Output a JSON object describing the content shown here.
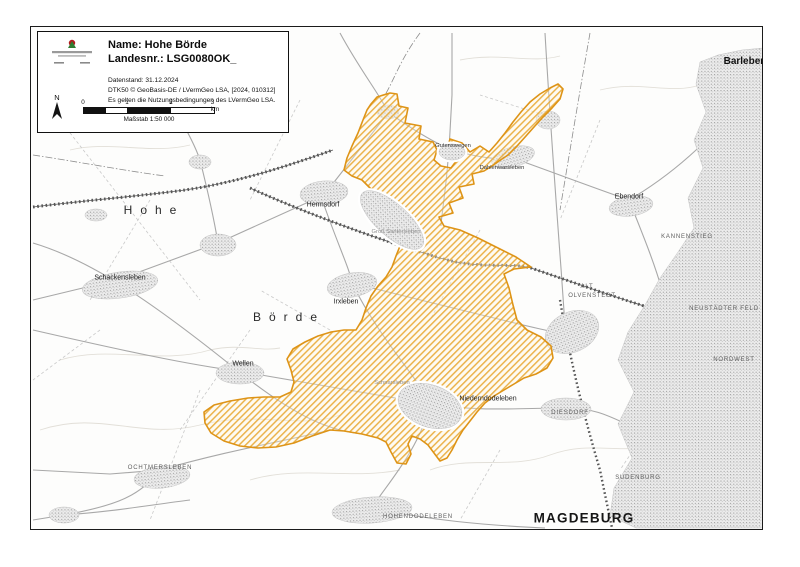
{
  "legend": {
    "name_label": "Name: Hohe Börde",
    "landesnr_label": "Landesnr.: LSG0080OK_",
    "datenstand": "Datenstand: 31.12.2024",
    "source": "DTK50 © GeoBasis-DE / LVermGeo LSA, [2024, 010312]",
    "terms": "Es gelten die Nutzungsbedingungen des LVermGeo LSA.",
    "north_label": "N",
    "scale_caption": "Maßstab 1:50 000",
    "scale_ticks": [
      "0",
      "1",
      "2",
      "3 km"
    ]
  },
  "colors": {
    "area_stroke": "#de9417",
    "area_hatch": "#e8a62e",
    "urban_fill": "#ececec",
    "road": "#a8a8a8",
    "rail": "#565656"
  },
  "map": {
    "area_name": "Hohe Börde",
    "labels": [
      {
        "text": "Hohe",
        "x": 154,
        "y": 210,
        "cls": "region"
      },
      {
        "text": "Börde",
        "x": 289,
        "y": 317,
        "cls": "region"
      },
      {
        "text": "Schackensleben",
        "x": 120,
        "y": 278,
        "cls": "place"
      },
      {
        "text": "Hermsdorf",
        "x": 323,
        "y": 205,
        "cls": "place"
      },
      {
        "text": "Irxleben",
        "x": 346,
        "y": 302,
        "cls": "place"
      },
      {
        "text": "Wellen",
        "x": 243,
        "y": 364,
        "cls": "place"
      },
      {
        "text": "Niederndodeleben",
        "x": 488,
        "y": 399,
        "cls": "place"
      },
      {
        "text": "Dahlenwarsleben",
        "x": 502,
        "y": 169,
        "cls": "place-sm"
      },
      {
        "text": "Gutenswegen",
        "x": 453,
        "y": 147,
        "cls": "place-sm"
      },
      {
        "text": "Groß Santersleben",
        "x": 396,
        "y": 233,
        "cls": "place-sm faint"
      },
      {
        "text": "Schnarsleben",
        "x": 392,
        "y": 384,
        "cls": "place-sm faint"
      },
      {
        "text": "Barleben",
        "x": 745,
        "y": 62,
        "cls": "place-lg"
      },
      {
        "text": "Ebendorf",
        "x": 629,
        "y": 197,
        "cls": "place"
      },
      {
        "text": "KANNENSTIEG",
        "x": 687,
        "y": 237,
        "cls": "caps"
      },
      {
        "text": "ALT",
        "x": 587,
        "y": 287,
        "cls": "caps"
      },
      {
        "text": "OLVENSTEDT",
        "x": 592,
        "y": 296,
        "cls": "caps"
      },
      {
        "text": "NEUSTÄDTER FELD",
        "x": 724,
        "y": 309,
        "cls": "caps"
      },
      {
        "text": "NORDWEST",
        "x": 734,
        "y": 360,
        "cls": "caps"
      },
      {
        "text": "DIESDORF",
        "x": 570,
        "y": 413,
        "cls": "caps"
      },
      {
        "text": "SUDENBURG",
        "x": 638,
        "y": 478,
        "cls": "caps"
      },
      {
        "text": "OCHTMERSLEBEN",
        "x": 160,
        "y": 468,
        "cls": "caps"
      },
      {
        "text": "HOHENDODELEBEN",
        "x": 418,
        "y": 517,
        "cls": "caps"
      },
      {
        "text": "MAGDEBURG",
        "x": 584,
        "y": 518,
        "cls": "city"
      }
    ]
  }
}
